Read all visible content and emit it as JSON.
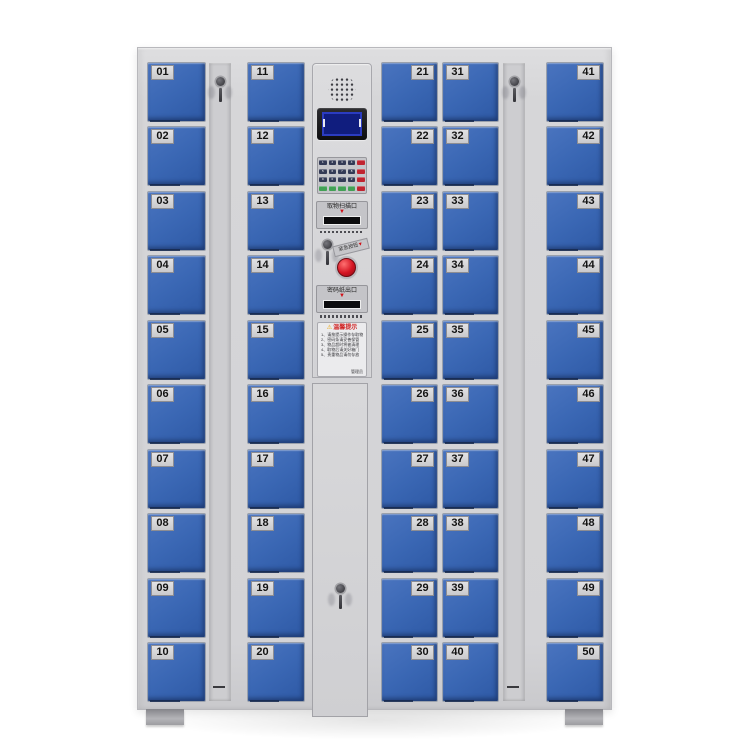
{
  "lockers": {
    "columns": [
      {
        "name": "column-1",
        "plate_side": "left",
        "doors": [
          "01",
          "02",
          "03",
          "04",
          "05",
          "06",
          "07",
          "08",
          "09",
          "10"
        ]
      },
      {
        "name": "column-2",
        "plate_side": "left",
        "doors": [
          "11",
          "12",
          "13",
          "14",
          "15",
          "16",
          "17",
          "18",
          "19",
          "20"
        ]
      },
      {
        "name": "column-3",
        "plate_side": "right",
        "doors": [
          "21",
          "22",
          "23",
          "24",
          "25",
          "26",
          "27",
          "28",
          "29",
          "30"
        ]
      },
      {
        "name": "column-4",
        "plate_side": "left",
        "doors": [
          "31",
          "32",
          "33",
          "34",
          "35",
          "36",
          "37",
          "38",
          "39",
          "40"
        ]
      },
      {
        "name": "column-5",
        "plate_side": "right",
        "doors": [
          "41",
          "42",
          "43",
          "44",
          "45",
          "46",
          "47",
          "48",
          "49",
          "50"
        ]
      }
    ],
    "colors": {
      "door_blue": "#3a67b4",
      "frame_gray": "#d6d6d8",
      "plate_gray": "#d3d3d5",
      "screen_blue": "#101d7e",
      "button_red": "#d41422",
      "warning_orange": "#f0a300",
      "label_red": "#d02020"
    }
  },
  "control_panel": {
    "speaker_icon": "speaker-grille",
    "display": {
      "type": "lcd-screen"
    },
    "keypad": {
      "rows": [
        {
          "keys": [
            "1",
            "2",
            "3",
            "4"
          ],
          "style": "dark"
        },
        {
          "keys": [
            "5",
            "6",
            "7",
            "8"
          ],
          "style": "dark"
        },
        {
          "keys": [
            "9",
            "0",
            "*",
            "#"
          ],
          "style": "dark"
        },
        {
          "keys": [
            "",
            "",
            "",
            ""
          ],
          "style": "green"
        }
      ],
      "side_key_color": "red"
    },
    "scan_slot": {
      "label": "取物扫描口",
      "arrow": "▼"
    },
    "emergency": {
      "label": "紧急按钮",
      "arrow": "▼"
    },
    "password_slot": {
      "label": "密码纸出口",
      "arrow": "▼"
    },
    "notice": {
      "warning_icon": "⚠",
      "title": "温馨提示",
      "lines": [
        "1、请按提示操作存取物品",
        "2、密码条请妥善保管",
        "3、物品超时将被清理",
        "4、取物后请关好箱门",
        "5、贵重物品请勿存放"
      ],
      "signature": "管理员"
    }
  }
}
